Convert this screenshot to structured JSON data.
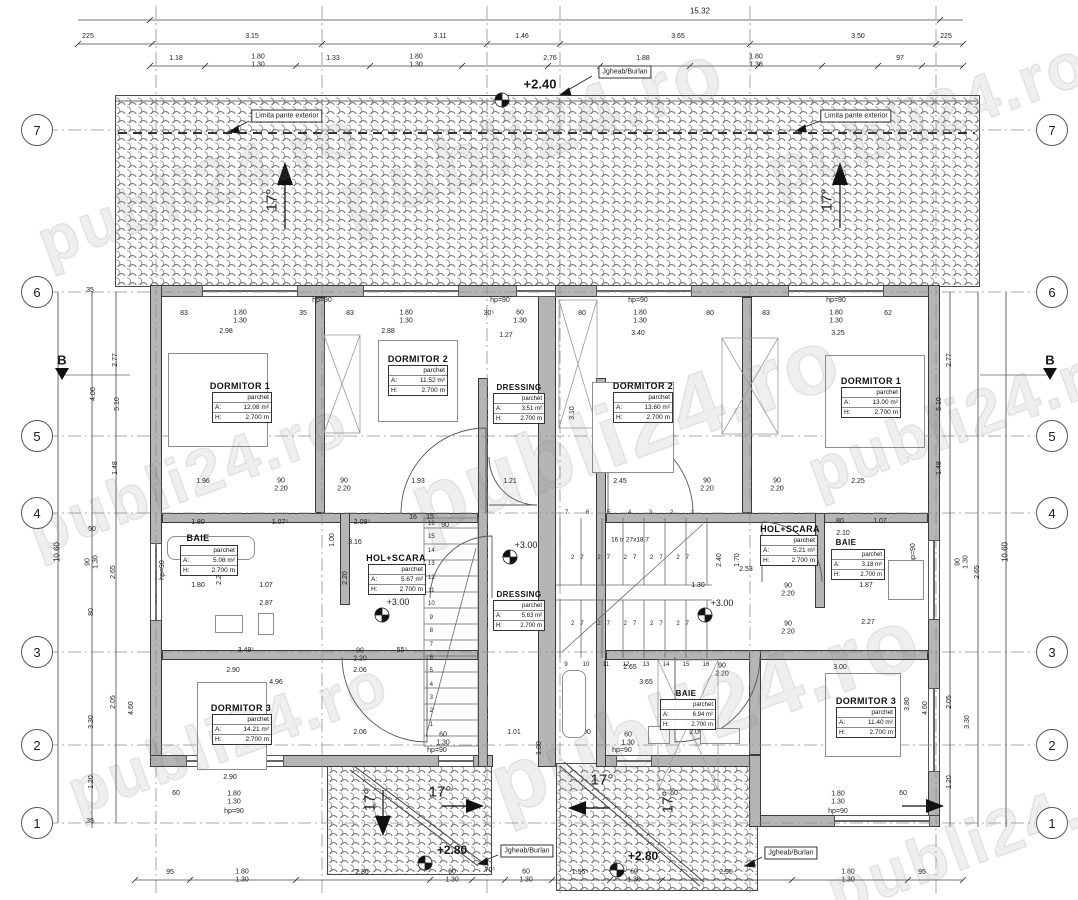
{
  "watermark": {
    "text": "publi24.ro"
  },
  "grid": {
    "left": [
      "7",
      "6",
      "5",
      "4",
      "3",
      "2",
      "1"
    ],
    "right": [
      "7",
      "6",
      "5",
      "4",
      "3",
      "2",
      "1"
    ],
    "section": "B"
  },
  "callouts": {
    "jgheab": "Jgheab/Burlan",
    "limita": "Limita pante exterior",
    "slope": "17°"
  },
  "levels": {
    "roof_top": "+2.40",
    "patch_left": "+2.80",
    "patch_right": "+2.80",
    "hol_left": "+3.00",
    "dressing": "+3.00",
    "hol_right": "+3.00"
  },
  "room_labels": {
    "a": "A:",
    "h": "H:"
  },
  "rooms": [
    {
      "name": "DORMITOR 1",
      "finish": "parchet",
      "area": "12.08 m²",
      "height": "2.700 m"
    },
    {
      "name": "DORMITOR 2",
      "finish": "parchet",
      "area": "11.52 m²",
      "height": "2.700 m"
    },
    {
      "name": "DRESSING",
      "finish": "parchet",
      "area": "3.51 m²",
      "height": "2.700 m"
    },
    {
      "name": "DORMITOR 2",
      "finish": "parchet",
      "area": "13.60 m²",
      "height": "2.700 m"
    },
    {
      "name": "DORMITOR 1",
      "finish": "parchet",
      "area": "13.00 m²",
      "height": "2.700 m"
    },
    {
      "name": "BAIE",
      "finish": "parchet",
      "area": "5.08 m²",
      "height": "2.700 m"
    },
    {
      "name": "HOL+SCARA",
      "finish": "parchet",
      "area": "5.67 m²",
      "height": "2.700 m"
    },
    {
      "name": "DRESSING",
      "finish": "parchet",
      "area": "5.63 m²",
      "height": "2.700 m"
    },
    {
      "name": "HOL+SCARA",
      "finish": "parchet",
      "area": "5.21 m²",
      "height": "2.700 m"
    },
    {
      "name": "BAIE",
      "finish": "parchet",
      "area": "3.18 m²",
      "height": "2.700 m"
    },
    {
      "name": "DORMITOR 3",
      "finish": "parchet",
      "area": "14.21 m²",
      "height": "2.700 m"
    },
    {
      "name": "BAIE",
      "finish": "parchet",
      "area": "6.94 m²",
      "height": "2.700 m"
    },
    {
      "name": "DORMITOR 3",
      "finish": "parchet",
      "area": "11.40 m²",
      "height": "2.700 m"
    }
  ],
  "stairs": {
    "annotation": "16 tr 27x18.7",
    "treads": "27 27 27 27 27",
    "left_numbers": [
      "16",
      "15",
      "14",
      "13",
      "12",
      "11",
      "10",
      "9",
      "8",
      "7",
      "6",
      "5",
      "4",
      "3",
      "2",
      "1"
    ],
    "right_top": [
      "7",
      "6",
      "5",
      "4",
      "3",
      "2",
      "1"
    ],
    "right_bottom": [
      "9",
      "10",
      "11",
      "12",
      "13",
      "14",
      "15",
      "16"
    ]
  },
  "dims": {
    "top_total": "15.32",
    "top_row1": [
      "225",
      "3.15",
      "3.11",
      "1.46",
      "3.65",
      "3.50",
      "225"
    ],
    "top_row2": [
      "1.18",
      "1.80\n1.30",
      "1.33",
      "1.80\n1.30",
      "2.76",
      "1.88",
      "1.80\n1.30",
      "97"
    ],
    "bottom": [
      "95",
      "1.80\n1.30",
      "2.86",
      "60\n1.30",
      "70⁵",
      "60\n1.30",
      "1.55⁵",
      "60\n1.30",
      "2.90",
      "1.80\n1.30",
      "95"
    ],
    "left": [
      "2.77",
      "4.00",
      "5.10",
      "1.48",
      "50",
      "90\n1.30",
      "2.65",
      "10.60",
      "80",
      "2.05",
      "3.30",
      "4.60",
      "1.20",
      "35",
      "35"
    ],
    "right": [
      "2.77",
      "5.10",
      "1.48",
      "90\n1.30",
      "2.65",
      "10.60",
      "2.05",
      "4.60",
      "3.30",
      "1.20"
    ],
    "plan": [
      "hp=90",
      "hp=90",
      "hp=90",
      "hp=90",
      "83",
      "1.80\n1.30",
      "35",
      "83",
      "1.80\n1.30",
      "30⁵",
      "60\n1.30",
      "80",
      "1.80\n1.30",
      "80",
      "83",
      "1.80\n1.30",
      "62",
      "2.98",
      "2.88",
      "1.27",
      "3.40",
      "3.25",
      "1.96",
      "90\n2.20",
      "90\n2.20",
      "1.93",
      "1.21",
      "2.45",
      "90\n2.20",
      "90\n2.20",
      "2.25",
      "1.80",
      "1.07⁵",
      "2.08⁵",
      "3.16",
      "90",
      "80",
      "1.07",
      "2.10",
      "1.80",
      "1.07",
      "2.87",
      "2.53",
      "1.30",
      "90\n2.20",
      "1.87",
      "90\n2.20",
      "2.27",
      "3.49⁵",
      "90\n2.20",
      "55⁵",
      "2.90",
      "2.65",
      "90\n2.20",
      "3.00",
      "4.96",
      "3.65",
      "2.06",
      "60\n1.30",
      "hp=90",
      "1.01",
      "1.00",
      "60\n1.30",
      "hp=90",
      "2.05",
      "2.90",
      "60",
      "1.80\n1.30",
      "hp=90",
      "60",
      "1.80\n1.30",
      "60",
      "hp=90",
      "3.10",
      "3.10",
      "4.00",
      "2.40",
      "1.70",
      "2.20",
      "2.20",
      "1.00",
      "hp=90",
      "hp=90",
      "1.90",
      "3.80",
      "2.06",
      "16",
      "15",
      "1.00"
    ]
  }
}
